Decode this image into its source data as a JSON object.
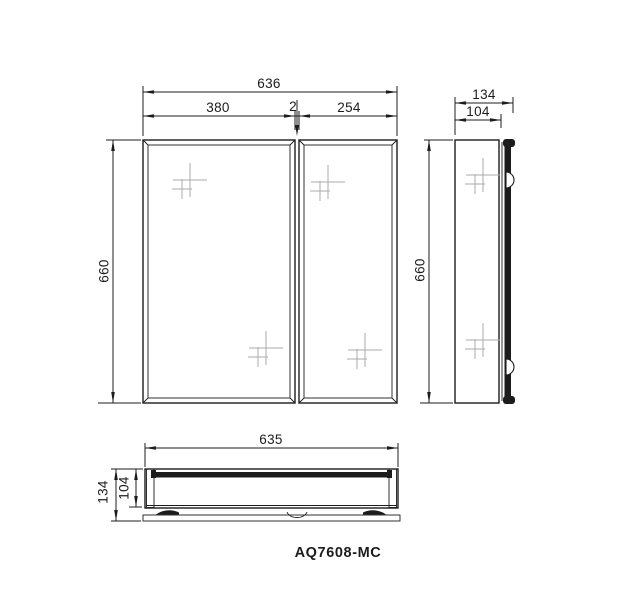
{
  "product_code": "AQ7608-MC",
  "views": {
    "front": {
      "dims": {
        "overall_width": "636",
        "left_door_width": "380",
        "door_gap": "2",
        "right_door_width": "254",
        "height": "660"
      }
    },
    "side": {
      "dims": {
        "overall_depth": "134",
        "body_depth": "104",
        "height": "660"
      }
    },
    "plan": {
      "dims": {
        "width": "635",
        "overall_depth": "134",
        "body_depth": "104"
      }
    }
  },
  "colors": {
    "line": "#1c1c1c",
    "sparkle": "#ababab",
    "background": "#ffffff"
  }
}
